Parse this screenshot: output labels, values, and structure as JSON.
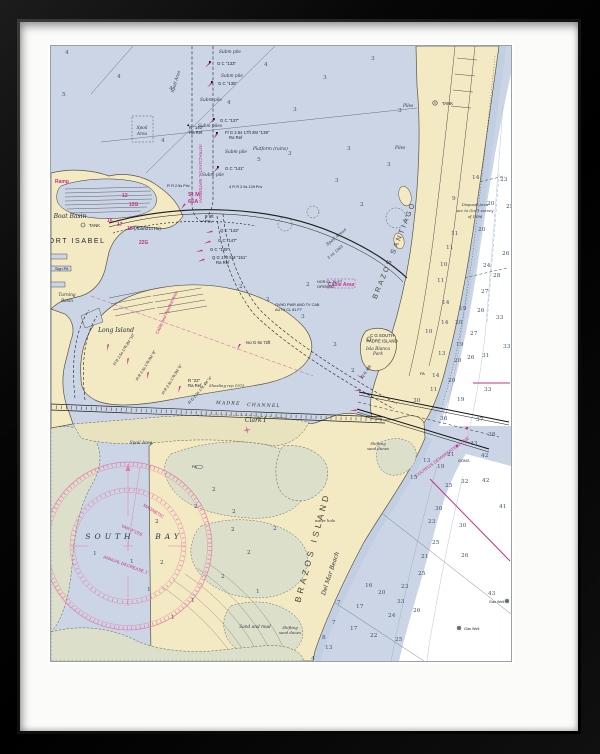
{
  "artwork": {
    "description_labels": "NOAA-style nautical chart of Port Isabel, South Bay and Brazos Island"
  },
  "labels": [
    {
      "x": 23,
      "y": 197,
      "t": "PORT ISABEL",
      "c": "city",
      "a": "middle"
    },
    {
      "x": 19,
      "y": 172,
      "t": "Boat Basin",
      "c": "pl-i",
      "a": "middle"
    },
    {
      "x": 38,
      "y": 181,
      "t": "TANK",
      "c": "nav"
    },
    {
      "x": 391,
      "y": 59,
      "t": "TANK",
      "c": "nav"
    },
    {
      "x": 65,
      "y": 286,
      "t": "Long Island",
      "c": "pl-i",
      "a": "middle"
    },
    {
      "x": 59,
      "y": 493,
      "t": "SOUTH",
      "c": "bay",
      "a": "middle"
    },
    {
      "x": 118,
      "y": 493,
      "t": "BAY",
      "c": "bay",
      "a": "middle"
    },
    {
      "x": 194,
      "y": 376,
      "t": "Clark I",
      "c": "pl-i"
    },
    {
      "x": 264,
      "y": 502,
      "t": "BRAZOS ISLAND",
      "c": "big",
      "r": -75,
      "a": "middle"
    },
    {
      "x": 281,
      "y": 528,
      "t": "Del Mar Beach",
      "c": "pl-i",
      "r": -72,
      "a": "middle"
    },
    {
      "x": 345,
      "y": 205,
      "t": "BRAZOS SANTIAGO",
      "c": "big2",
      "r": -68,
      "a": "middle"
    },
    {
      "x": 331,
      "y": 291,
      "t": "C G SOUTH",
      "c": "nav",
      "a": "middle"
    },
    {
      "x": 331,
      "y": 296.5,
      "t": "PADRE ISLAND",
      "c": "nav",
      "a": "middle"
    },
    {
      "x": 327,
      "y": 304,
      "t": "Isla Blanca",
      "c": "navi",
      "a": "middle"
    },
    {
      "x": 327,
      "y": 309,
      "t": "Park",
      "c": "navi",
      "a": "middle"
    },
    {
      "x": 327,
      "y": 399,
      "t": "Shifting",
      "c": "tnyi",
      "a": "middle"
    },
    {
      "x": 327,
      "y": 404,
      "t": "sand dunes",
      "c": "tnyi",
      "a": "middle"
    },
    {
      "x": 239,
      "y": 583,
      "t": "Shifting",
      "c": "tnyi",
      "a": "middle"
    },
    {
      "x": 239,
      "y": 588,
      "t": "sand dunes",
      "c": "tnyi",
      "a": "middle"
    },
    {
      "x": 204,
      "y": 582,
      "t": "Sand and mud",
      "c": "navi",
      "a": "middle"
    },
    {
      "x": 274,
      "y": 476,
      "t": "water hole",
      "c": "tnyi",
      "a": "middle"
    },
    {
      "x": 165,
      "y": 358,
      "t": "MADRE",
      "c": "chan",
      "r": 2
    },
    {
      "x": 196,
      "y": 360,
      "t": "CHANNEL",
      "c": "chan",
      "r": 2
    },
    {
      "x": 148,
      "y": 128,
      "t": "INTRACOASTAL WATERWAY",
      "c": "mag",
      "r": 90,
      "a": "middle"
    },
    {
      "x": 137,
      "y": 150,
      "t": "St M",
      "c": "magb"
    },
    {
      "x": 137,
      "y": 157,
      "t": "66A",
      "c": "magb"
    },
    {
      "x": 71,
      "y": 151,
      "t": "12",
      "c": "magn"
    },
    {
      "x": 78,
      "y": 160,
      "t": "12G",
      "c": "magn"
    },
    {
      "x": 56,
      "y": 176,
      "t": "16",
      "c": "magn"
    },
    {
      "x": 66,
      "y": 180,
      "t": "17",
      "c": "magn"
    },
    {
      "x": 76,
      "y": 184,
      "t": "18",
      "c": "magn"
    },
    {
      "x": 83,
      "y": 184,
      "t": "(Aband Lt Ho)",
      "c": "nav"
    },
    {
      "x": 88,
      "y": 198,
      "t": "22G",
      "c": "magn"
    },
    {
      "x": 4,
      "y": 137,
      "t": "Ramp",
      "c": "magn"
    },
    {
      "x": 117,
      "y": 267,
      "t": "Cable and Pipeline Area",
      "c": "mag",
      "r": -65,
      "a": "middle"
    },
    {
      "x": 290,
      "y": 240,
      "t": "Cable Area",
      "c": "magn",
      "a": "middle"
    },
    {
      "x": 392,
      "y": 412,
      "t": "COLREGS DEMARCATION LINE",
      "c": "mag",
      "r": -36,
      "a": "middle"
    },
    {
      "x": 92,
      "y": 460,
      "t": "MAGNETIC",
      "c": "mag",
      "r": 32
    },
    {
      "x": 70,
      "y": 481,
      "t": "VAR 8°15'E",
      "c": "mag",
      "r": 24
    },
    {
      "x": 52,
      "y": 512,
      "t": "ANNUAL DECREASE 1'",
      "c": "mag",
      "r": 20
    },
    {
      "x": 166,
      "y": 19,
      "t": "G C \"133\"",
      "c": "nav"
    },
    {
      "x": 167,
      "y": 39,
      "t": "G C \"135\"",
      "c": "nav"
    },
    {
      "x": 169,
      "y": 76,
      "t": "G C \"137\"",
      "c": "nav"
    },
    {
      "x": 174,
      "y": 88,
      "t": "Fl G 2.5s 17ft 2M \"139\"",
      "c": "nav"
    },
    {
      "x": 178,
      "y": 93,
      "t": "Ra Ref",
      "c": "nav"
    },
    {
      "x": 174,
      "y": 124,
      "t": "G C \"141\"",
      "c": "nav"
    },
    {
      "x": 138,
      "y": 83,
      "t": "R \"140\"",
      "c": "nav"
    },
    {
      "x": 138,
      "y": 88,
      "t": "Ra Ref",
      "c": "nav"
    },
    {
      "x": 169,
      "y": 186,
      "t": "Q C \"143\"",
      "c": "nav"
    },
    {
      "x": 167,
      "y": 196,
      "t": "G C \"147\"",
      "c": "nav"
    },
    {
      "x": 159,
      "y": 205,
      "t": "G C \"149\"",
      "c": "nav"
    },
    {
      "x": 161,
      "y": 213,
      "t": "Q G 17ft 5M \"151\"",
      "c": "nav"
    },
    {
      "x": 165,
      "y": 218,
      "t": "Ra Ref",
      "c": "nav"
    },
    {
      "x": 178,
      "y": 142,
      "t": "4 Fl R 2.5s 12ft Priv",
      "c": "tny"
    },
    {
      "x": 116,
      "y": 141,
      "t": "Fl R 2.5s Priv",
      "c": "tny"
    },
    {
      "x": 154,
      "y": 172,
      "t": "F 9ft",
      "c": "nav"
    },
    {
      "x": 154,
      "y": 177,
      "t": "Priv",
      "c": "nav"
    },
    {
      "x": 195,
      "y": 298,
      "t": "Iso G 6s 72ft",
      "c": "nav"
    },
    {
      "x": 137,
      "y": 336,
      "t": "R \"22\"",
      "c": "nav"
    },
    {
      "x": 137,
      "y": 341,
      "t": "Ra Ref",
      "c": "nav"
    },
    {
      "x": 266,
      "y": 237,
      "t": "HOR CL 36 FT",
      "c": "tny"
    },
    {
      "x": 266,
      "y": 242,
      "t": "OPENING",
      "c": "tny"
    },
    {
      "x": 224,
      "y": 260,
      "t": "OVHD PWR AND TV CAB",
      "c": "tny"
    },
    {
      "x": 224,
      "y": 265,
      "t": "AUTH CL 81 FT",
      "c": "tny"
    },
    {
      "x": 312,
      "y": 332,
      "t": "Q G 36ft",
      "c": "tny",
      "r": -55
    },
    {
      "x": 407,
      "y": 416,
      "t": "GONG",
      "c": "tny"
    },
    {
      "x": 438,
      "y": 557,
      "t": "Gas Well",
      "c": "tny"
    },
    {
      "x": 413,
      "y": 584,
      "t": "Gas Well",
      "c": "tny"
    },
    {
      "x": 96,
      "y": 320,
      "t": "Fl R 2.5s 17ft 3M \"8\"",
      "c": "tny",
      "r": -58,
      "a": "middle"
    },
    {
      "x": 122,
      "y": 334,
      "t": "Fl R 2.5s 17ft 3M \"6\"",
      "c": "tny",
      "r": -58,
      "a": "middle"
    },
    {
      "x": 74,
      "y": 304,
      "t": "Fl R 2.5s 17ft 2M \"10\"",
      "c": "tny",
      "r": -58,
      "a": "middle"
    },
    {
      "x": 150,
      "y": 345,
      "t": "Fl G 2.5s 17ft 4M \"4\"",
      "c": "tny",
      "r": -50,
      "a": "middle"
    },
    {
      "x": 168,
      "y": 7,
      "t": "Subm pile",
      "c": "navi"
    },
    {
      "x": 170,
      "y": 31,
      "t": "Subm pile",
      "c": "navi"
    },
    {
      "x": 149,
      "y": 55,
      "t": "Subm pile",
      "c": "navi"
    },
    {
      "x": 174,
      "y": 107,
      "t": "Subm pile",
      "c": "navi"
    },
    {
      "x": 151,
      "y": 130,
      "t": "Subm pile",
      "c": "navi"
    },
    {
      "x": 147,
      "y": 81,
      "t": "Subm piles",
      "c": "navi"
    },
    {
      "x": 202,
      "y": 104,
      "t": "Platform (ruins)",
      "c": "navi"
    },
    {
      "x": 126,
      "y": 36,
      "t": "Spoil Area",
      "c": "navi",
      "r": -73,
      "a": "middle"
    },
    {
      "x": 91,
      "y": 83,
      "t": "Spoil",
      "c": "navi",
      "a": "middle"
    },
    {
      "x": 91,
      "y": 89,
      "t": "Area",
      "c": "navi",
      "a": "middle"
    },
    {
      "x": 90,
      "y": 398,
      "t": "Spoil Area",
      "c": "navi",
      "a": "middle"
    },
    {
      "x": 286,
      "y": 192,
      "t": "Spoil Areas",
      "c": "navi",
      "r": -40,
      "a": "middle"
    },
    {
      "x": 158,
      "y": 341,
      "t": "Shoaling rep 1973",
      "c": "tnyi"
    },
    {
      "x": 352,
      "y": 61,
      "t": "Piles",
      "c": "navi"
    },
    {
      "x": 344,
      "y": 103,
      "t": "Piles",
      "c": "navi"
    },
    {
      "x": 16,
      "y": 250,
      "t": "Turning",
      "c": "navi",
      "a": "middle"
    },
    {
      "x": 16,
      "y": 256,
      "t": "Basin",
      "c": "navi",
      "a": "middle"
    },
    {
      "x": 4,
      "y": 224,
      "t": "Sign PA",
      "c": "tny"
    },
    {
      "x": 141,
      "y": 422,
      "t": "PA",
      "c": "tny"
    },
    {
      "x": 369,
      "y": 329,
      "t": "PA",
      "c": "tny"
    },
    {
      "x": 424,
      "y": 160,
      "t": "Disposal Area",
      "c": "tnyi",
      "a": "middle"
    },
    {
      "x": 424,
      "y": 166,
      "t": "acc to Gov't survey",
      "c": "tnyi",
      "a": "middle"
    },
    {
      "x": 424,
      "y": 172,
      "t": "of 1996",
      "c": "tnyi",
      "a": "middle"
    },
    {
      "x": 285,
      "y": 207,
      "t": "3 mi 1963",
      "c": "tnyi",
      "r": -40,
      "a": "middle"
    }
  ],
  "soundings": [
    {
      "x": 14,
      "y": 8,
      "v": "4"
    },
    {
      "x": 11,
      "y": 50,
      "v": "5"
    },
    {
      "x": 66,
      "y": 32,
      "v": "4"
    },
    {
      "x": 118,
      "y": 44,
      "v": "4"
    },
    {
      "x": 213,
      "y": 20,
      "v": "4"
    },
    {
      "x": 272,
      "y": 33,
      "v": "3"
    },
    {
      "x": 320,
      "y": 14,
      "v": "3"
    },
    {
      "x": 242,
      "y": 65,
      "v": "3"
    },
    {
      "x": 347,
      "y": 66,
      "v": "3"
    },
    {
      "x": 296,
      "y": 104,
      "v": "3"
    },
    {
      "x": 237,
      "y": 109,
      "v": "3"
    },
    {
      "x": 284,
      "y": 136,
      "v": "3"
    },
    {
      "x": 206,
      "y": 115,
      "v": "5"
    },
    {
      "x": 110,
      "y": 96,
      "v": "4"
    },
    {
      "x": 176,
      "y": 58,
      "v": "4"
    },
    {
      "x": 309,
      "y": 160,
      "v": "2"
    },
    {
      "x": 336,
      "y": 120,
      "v": "3"
    },
    {
      "x": 188,
      "y": 242,
      "v": "2"
    },
    {
      "x": 215,
      "y": 255,
      "v": "2"
    },
    {
      "x": 250,
      "y": 272,
      "v": "3"
    },
    {
      "x": 282,
      "y": 300,
      "v": "3"
    },
    {
      "x": 300,
      "y": 326,
      "v": "2"
    },
    {
      "x": 255,
      "y": 240,
      "v": "2"
    },
    {
      "x": 143,
      "y": 462,
      "v": "2"
    },
    {
      "x": 181,
      "y": 467,
      "v": "2"
    },
    {
      "x": 104,
      "y": 477,
      "v": "2"
    },
    {
      "x": 161,
      "y": 445,
      "v": "2"
    },
    {
      "x": 180,
      "y": 485,
      "v": "2"
    },
    {
      "x": 42,
      "y": 509,
      "v": "1"
    },
    {
      "x": 79,
      "y": 517,
      "v": "1"
    },
    {
      "x": 109,
      "y": 518,
      "v": "2"
    },
    {
      "x": 96,
      "y": 545,
      "v": "1"
    },
    {
      "x": 140,
      "y": 556,
      "v": "1"
    },
    {
      "x": 196,
      "y": 508,
      "v": "2"
    },
    {
      "x": 222,
      "y": 484,
      "v": "2"
    },
    {
      "x": 120,
      "y": 573,
      "v": "1"
    },
    {
      "x": 170,
      "y": 532,
      "v": "2"
    },
    {
      "x": 205,
      "y": 547,
      "v": "1"
    },
    {
      "x": 421,
      "y": 133,
      "v": "14"
    },
    {
      "x": 449,
      "y": 135,
      "v": "23"
    },
    {
      "x": 401,
      "y": 154,
      "v": "9"
    },
    {
      "x": 436,
      "y": 159,
      "v": "20"
    },
    {
      "x": 455,
      "y": 162,
      "v": "25"
    },
    {
      "x": 400,
      "y": 189,
      "v": "11"
    },
    {
      "x": 427,
      "y": 185,
      "v": "20"
    },
    {
      "x": 395,
      "y": 203,
      "v": "11"
    },
    {
      "x": 451,
      "y": 209,
      "v": "26"
    },
    {
      "x": 389,
      "y": 220,
      "v": "10"
    },
    {
      "x": 432,
      "y": 221,
      "v": "24"
    },
    {
      "x": 442,
      "y": 231,
      "v": "28"
    },
    {
      "x": 386,
      "y": 236,
      "v": "11"
    },
    {
      "x": 430,
      "y": 247,
      "v": "27"
    },
    {
      "x": 391,
      "y": 258,
      "v": "14"
    },
    {
      "x": 408,
      "y": 264,
      "v": "19"
    },
    {
      "x": 426,
      "y": 266,
      "v": "26"
    },
    {
      "x": 445,
      "y": 273,
      "v": "33"
    },
    {
      "x": 390,
      "y": 278,
      "v": "14"
    },
    {
      "x": 404,
      "y": 278,
      "v": "20"
    },
    {
      "x": 419,
      "y": 289,
      "v": "27"
    },
    {
      "x": 374,
      "y": 287,
      "v": "10"
    },
    {
      "x": 405,
      "y": 300,
      "v": "19"
    },
    {
      "x": 452,
      "y": 302,
      "v": "33"
    },
    {
      "x": 387,
      "y": 309,
      "v": "13"
    },
    {
      "x": 403,
      "y": 316,
      "v": "20"
    },
    {
      "x": 416,
      "y": 313,
      "v": "26"
    },
    {
      "x": 431,
      "y": 311,
      "v": "31"
    },
    {
      "x": 381,
      "y": 331,
      "v": "14"
    },
    {
      "x": 397,
      "y": 336,
      "v": "20"
    },
    {
      "x": 379,
      "y": 345,
      "v": "11"
    },
    {
      "x": 433,
      "y": 345,
      "v": "33"
    },
    {
      "x": 406,
      "y": 355,
      "v": "19"
    },
    {
      "x": 362,
      "y": 356,
      "v": "30"
    },
    {
      "x": 389,
      "y": 374,
      "v": "36"
    },
    {
      "x": 425,
      "y": 375,
      "v": "37"
    },
    {
      "x": 437,
      "y": 390,
      "v": "38"
    },
    {
      "x": 419,
      "y": 399,
      "v": "43"
    },
    {
      "x": 396,
      "y": 410,
      "v": "21"
    },
    {
      "x": 430,
      "y": 411,
      "v": "42"
    },
    {
      "x": 372,
      "y": 416,
      "v": "13"
    },
    {
      "x": 386,
      "y": 422,
      "v": "19"
    },
    {
      "x": 359,
      "y": 433,
      "v": "15"
    },
    {
      "x": 410,
      "y": 437,
      "v": "32"
    },
    {
      "x": 431,
      "y": 436,
      "v": "42"
    },
    {
      "x": 448,
      "y": 462,
      "v": "41"
    },
    {
      "x": 394,
      "y": 441,
      "v": "25"
    },
    {
      "x": 384,
      "y": 464,
      "v": "30"
    },
    {
      "x": 377,
      "y": 477,
      "v": "23"
    },
    {
      "x": 408,
      "y": 481,
      "v": "30"
    },
    {
      "x": 381,
      "y": 498,
      "v": "25"
    },
    {
      "x": 370,
      "y": 512,
      "v": "21"
    },
    {
      "x": 410,
      "y": 511,
      "v": "26"
    },
    {
      "x": 367,
      "y": 529,
      "v": "25"
    },
    {
      "x": 437,
      "y": 549,
      "v": "43"
    },
    {
      "x": 362,
      "y": 566,
      "v": "26"
    },
    {
      "x": 314,
      "y": 541,
      "v": "16"
    },
    {
      "x": 350,
      "y": 542,
      "v": "23"
    },
    {
      "x": 327,
      "y": 548,
      "v": "20"
    },
    {
      "x": 346,
      "y": 557,
      "v": "33"
    },
    {
      "x": 337,
      "y": 571,
      "v": "24"
    },
    {
      "x": 286,
      "y": 558,
      "v": "7"
    },
    {
      "x": 305,
      "y": 562,
      "v": "17"
    },
    {
      "x": 281,
      "y": 578,
      "v": "7"
    },
    {
      "x": 299,
      "y": 584,
      "v": "17"
    },
    {
      "x": 319,
      "y": 591,
      "v": "22"
    },
    {
      "x": 344,
      "y": 595,
      "v": "25"
    },
    {
      "x": 271,
      "y": 593,
      "v": "8"
    },
    {
      "x": 274,
      "y": 603,
      "v": "13"
    },
    {
      "x": 260,
      "y": 614,
      "v": "4"
    }
  ],
  "colors": {
    "water": "#cbd5e6",
    "land": "#f3e9c3",
    "marsh": "#dce0ca",
    "magenta": "#c2338b",
    "rose": "#e57da8",
    "gulf": "#ffffff"
  }
}
